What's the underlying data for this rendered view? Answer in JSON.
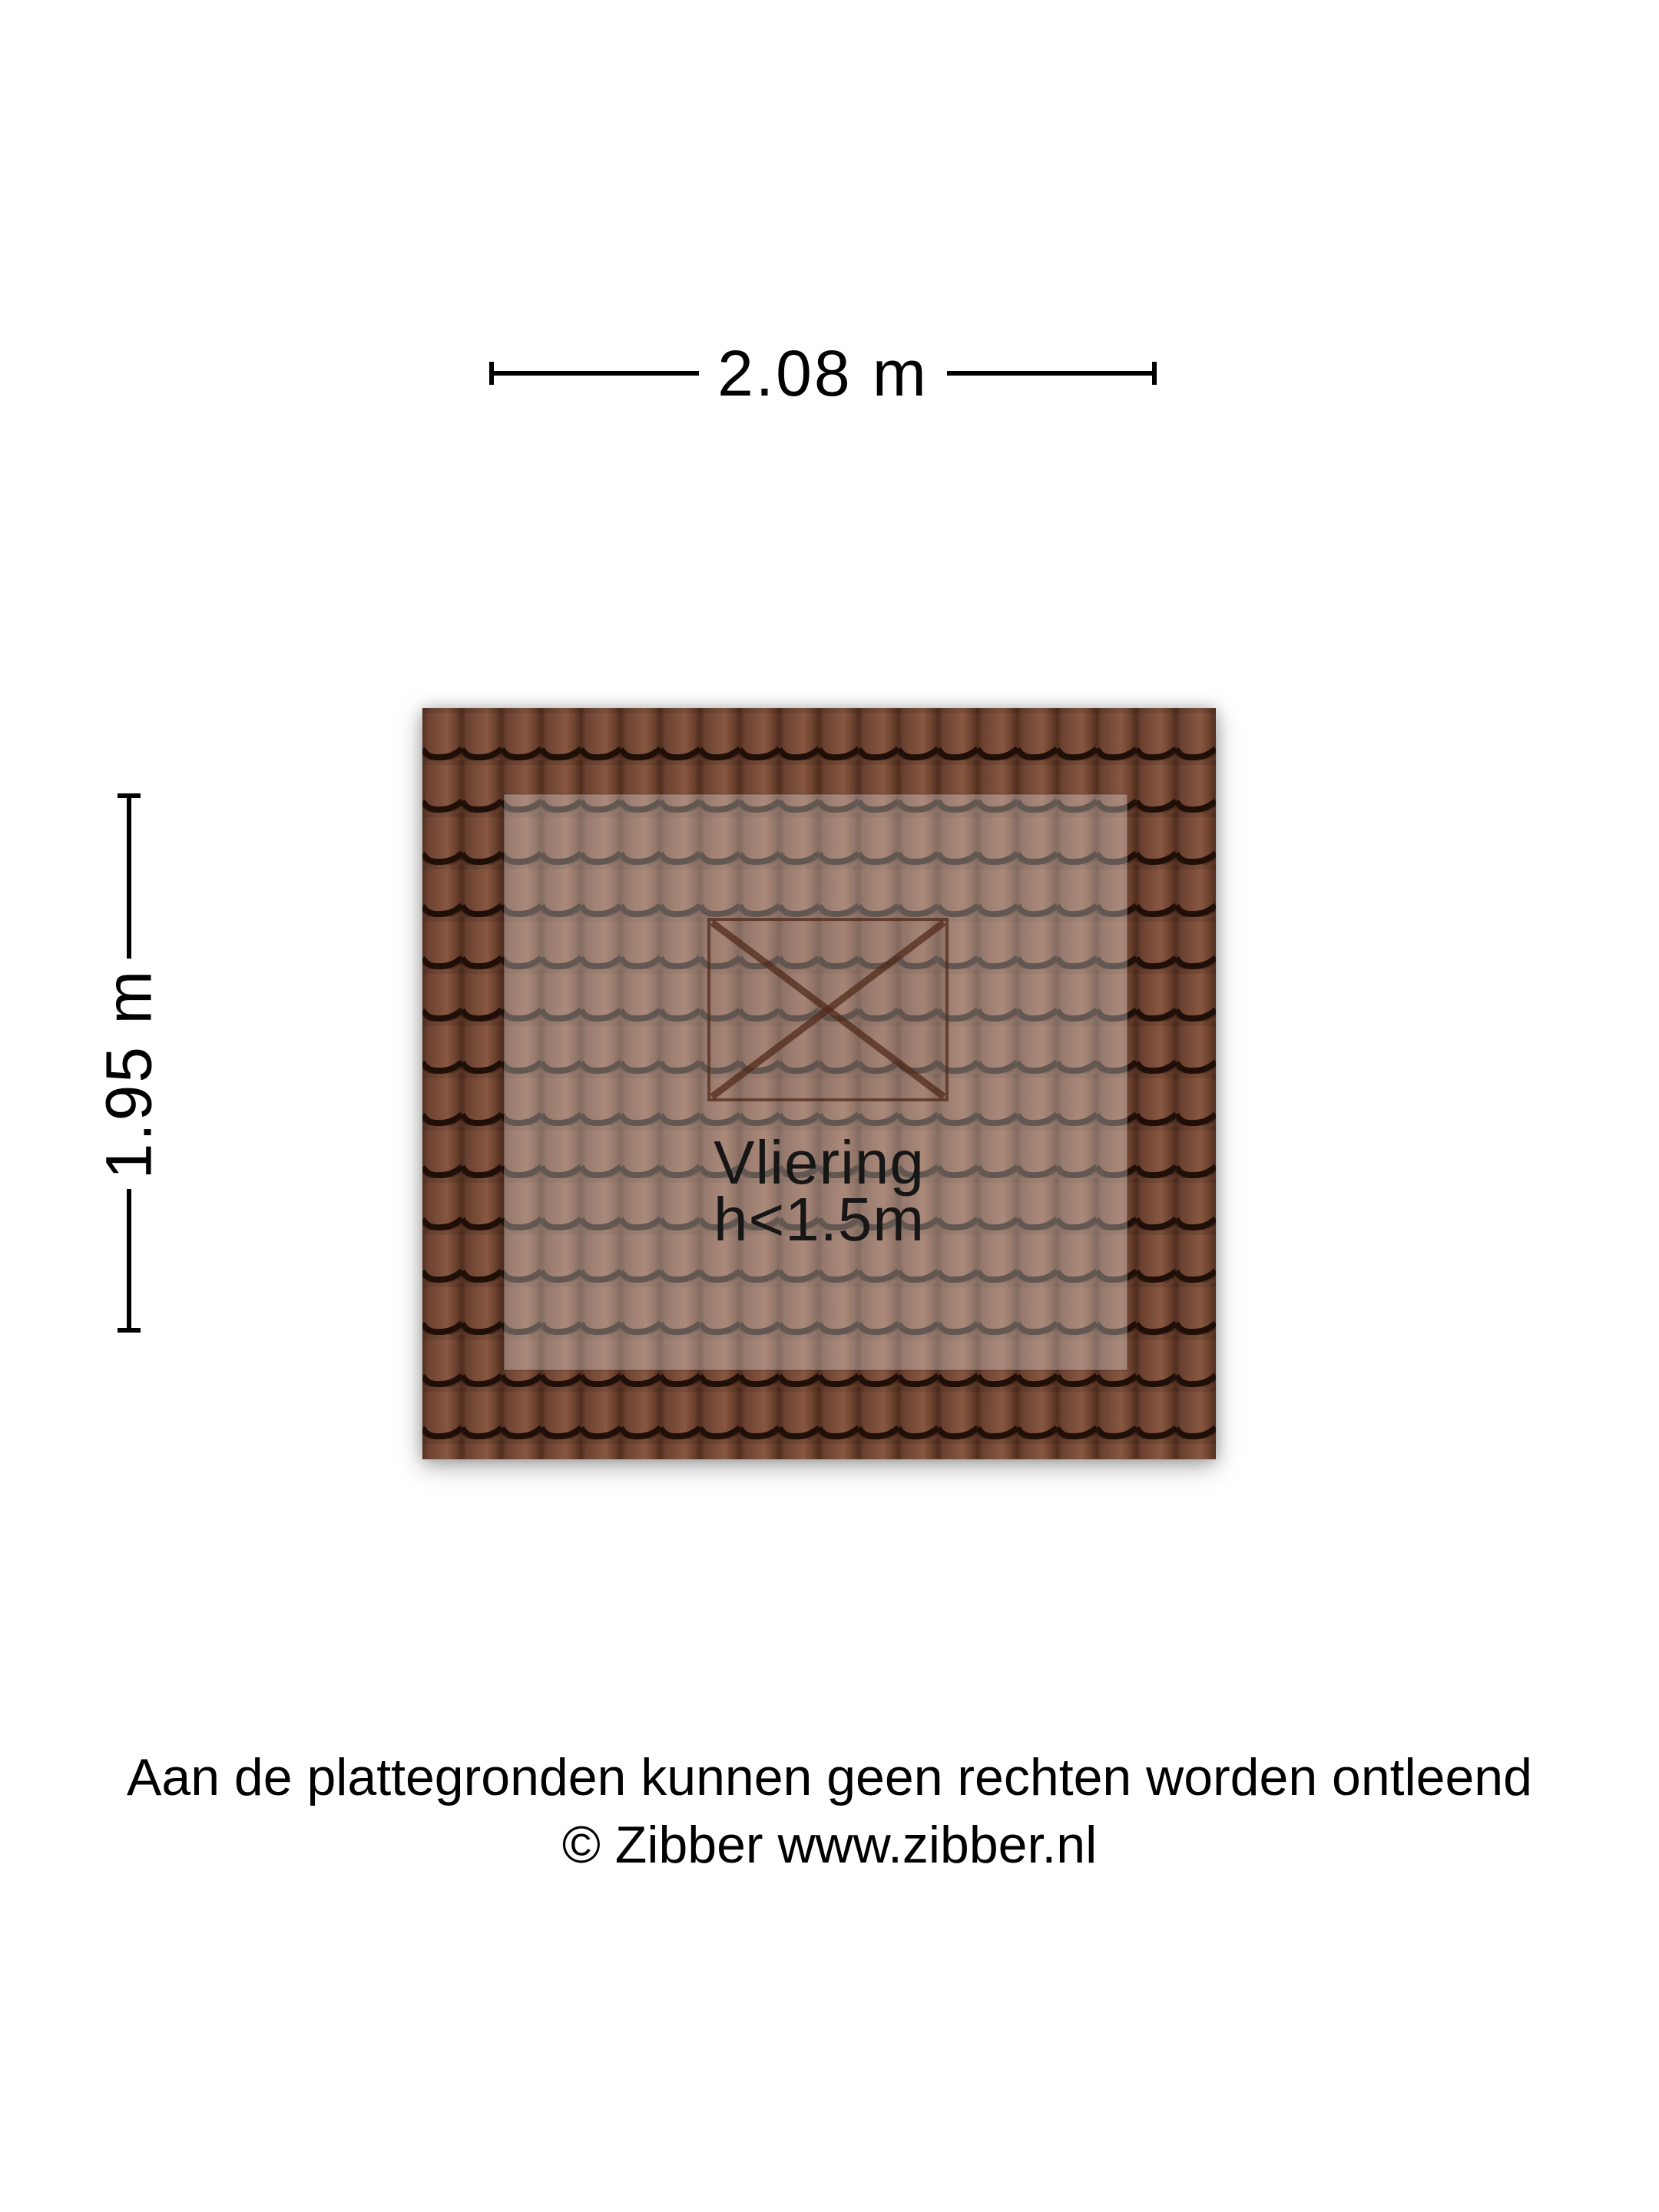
{
  "page": {
    "background": "#ffffff"
  },
  "dimensions": {
    "width": {
      "label": "2.08 m"
    },
    "height": {
      "label": "1.95 m"
    }
  },
  "room": {
    "name": "Vliering",
    "height_note": "h<1.5m"
  },
  "roof": {
    "symbol": "roof-hatch-x",
    "colors": {
      "tile_body": "#7b4e3a",
      "tile_seam": "#512e1f",
      "tile_wave_line": "#200f08",
      "inner_area_overlay": "rgba(255,255,255,0.30)",
      "hatch_symbol": "#4f2817"
    }
  },
  "footer": {
    "line1": "Aan de plattegronden kunnen geen rechten worden ontleend",
    "line2": "© Zibber www.zibber.nl"
  }
}
